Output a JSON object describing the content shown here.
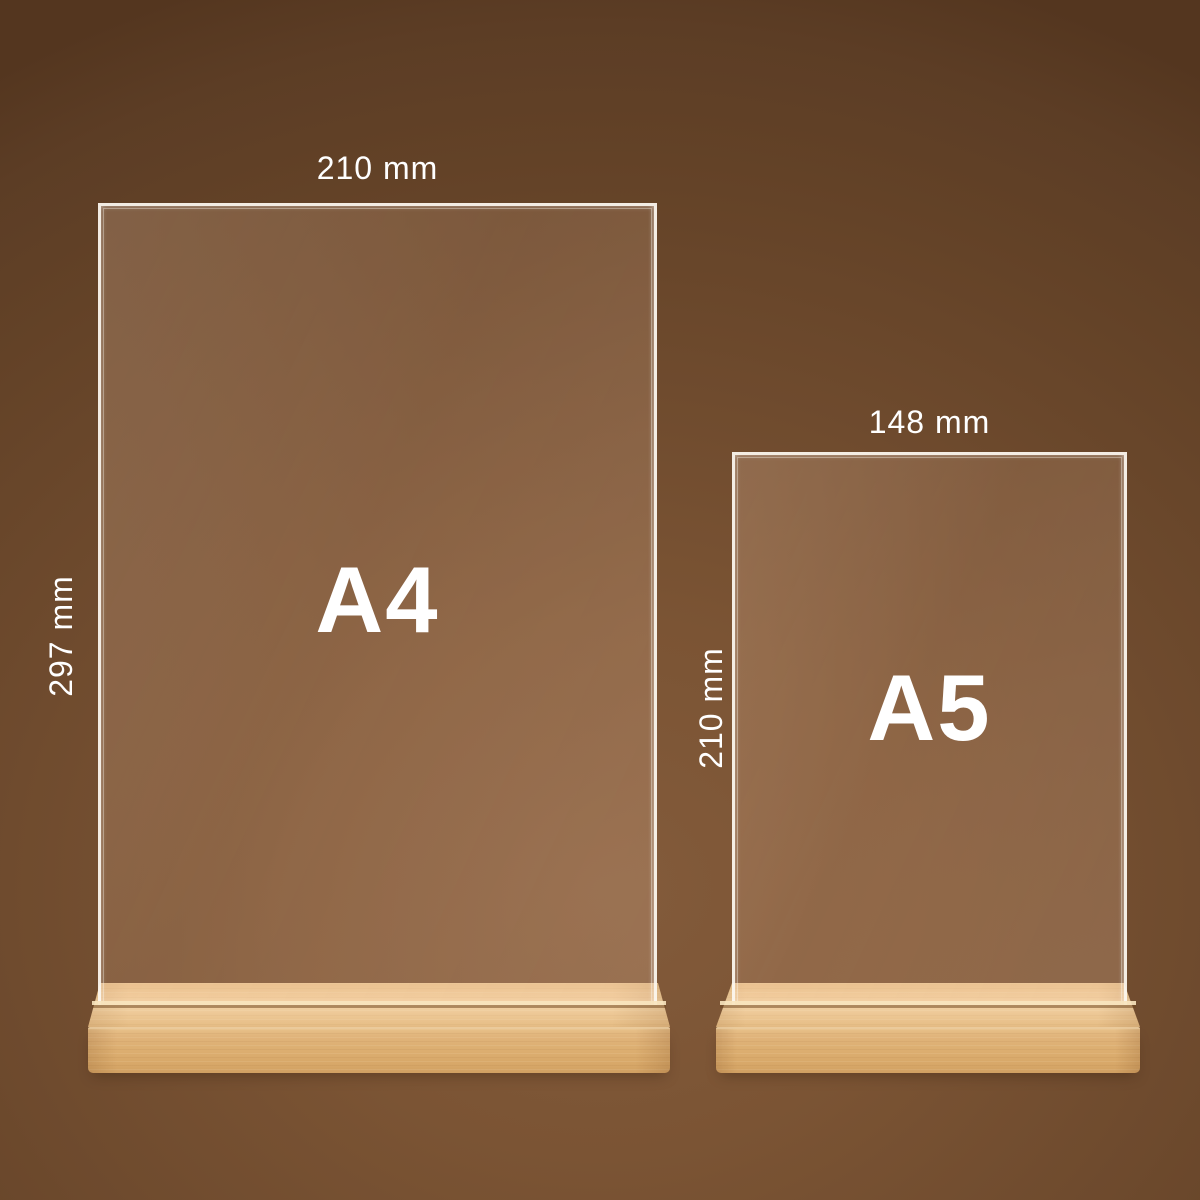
{
  "stands": [
    {
      "size_label": "A4",
      "width_label": "210 mm",
      "height_label": "297 mm"
    },
    {
      "size_label": "A5",
      "width_label": "148 mm",
      "height_label": "210 mm"
    }
  ],
  "colors": {
    "label_text": "#ffffff",
    "panel_edge": "#fcf8f0",
    "wood_top": "#eeca98",
    "wood_front": "#dcae70",
    "bg_center": "#835b3b",
    "bg_edge": "#54361f"
  }
}
